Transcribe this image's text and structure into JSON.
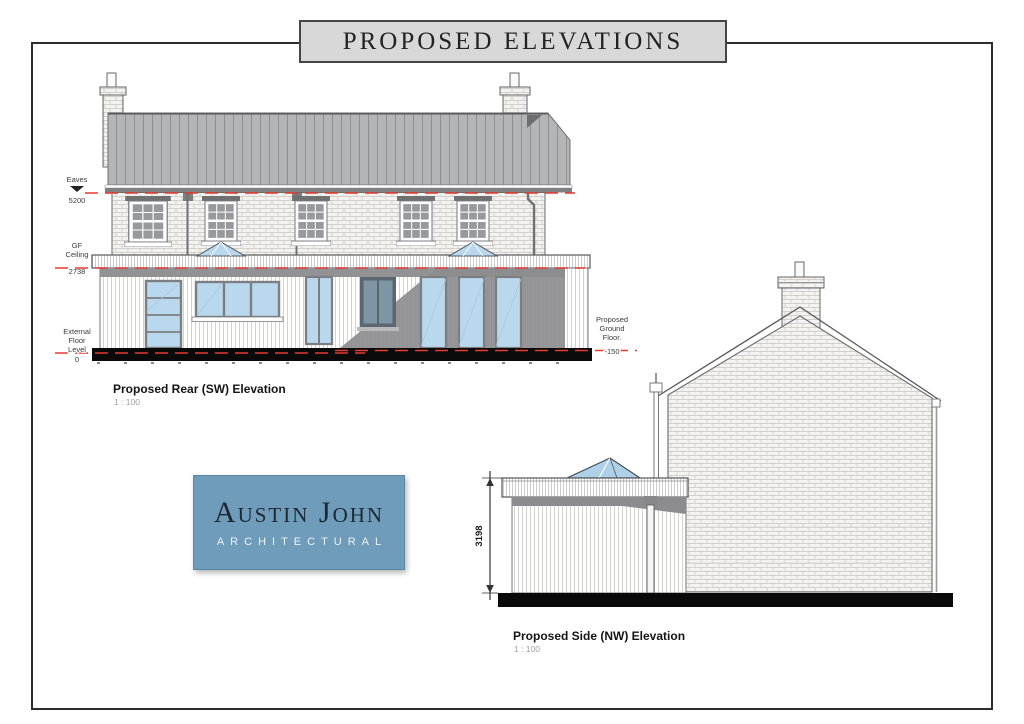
{
  "page": {
    "title": "PROPOSED ELEVATIONS"
  },
  "logo": {
    "name": "Austin John",
    "subtitle": "ARCHITECTURAL"
  },
  "rear_elevation": {
    "caption": "Proposed Rear (SW) Elevation",
    "scale": "1 : 100",
    "levels": {
      "eaves": {
        "line1": "Eaves",
        "value": "5200"
      },
      "gf_ceiling": {
        "line1": "GF",
        "line2": "Ceiling",
        "value": "2738"
      },
      "external_floor": {
        "line1": "External",
        "line2": "Floor",
        "line3": "Level",
        "value": "0"
      },
      "proposed_ground_floor": {
        "line1": "Proposed",
        "line2": "Ground",
        "line3": "Floor.",
        "value": "-150"
      }
    }
  },
  "side_elevation": {
    "caption": "Proposed Side (NW) Elevation",
    "scale": "1 : 100",
    "height_dimension": "3198"
  },
  "colors": {
    "banner_bg": "#d8d8d8",
    "logo_bg": "#6f9cba",
    "level_line": "#e8392e",
    "glazing": "#b9d8ee",
    "glazing_shadow": "#7e95a6",
    "roof": "#b4b5b7",
    "shadow": "#8d8d8f",
    "plinth": "#0a0a0a"
  }
}
